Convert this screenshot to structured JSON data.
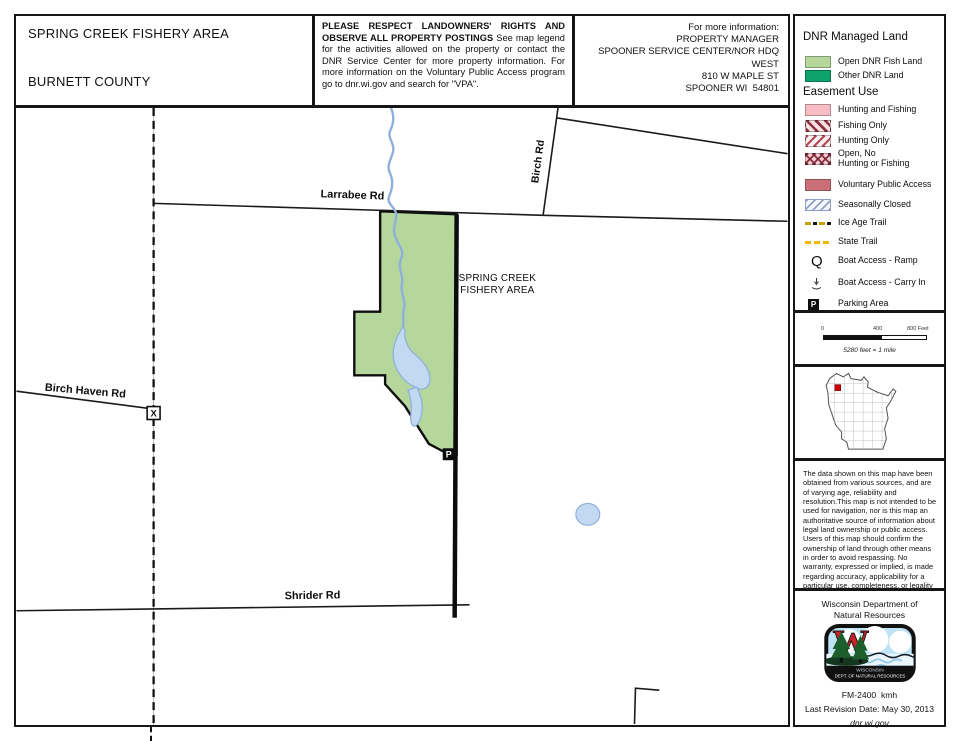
{
  "header": {
    "title": "SPRING CREEK FISHERY AREA",
    "county": "BURNETT COUNTY",
    "notice": {
      "heading": "PLEASE RESPECT LANDOWNERS' RIGHTS AND OBSERVE ALL PROPERTY POSTINGS",
      "body": "See map legend for the activities allowed on the property or contact the DNR Service Center for more property information. For more information on the Voluntary Public Access program go to dnr.wi.gov and search for \"VPA\"."
    },
    "contact": {
      "lines": [
        "For more information:",
        "PROPERTY MANAGER",
        "SPOONER SERVICE CENTER/NOR HDQ",
        "WEST",
        "810 W MAPLE ST",
        "SPOONER WI  54801"
      ]
    }
  },
  "legend": {
    "managed_heading": "DNR Managed Land",
    "managed": [
      {
        "label": "Open DNR Fish Land"
      },
      {
        "label": "Other DNR Land"
      }
    ],
    "easement_heading": "Easement Use",
    "easement": [
      {
        "label": "Hunting and Fishing"
      },
      {
        "label": "Fishing Only"
      },
      {
        "label": "Hunting Only"
      },
      {
        "line1": "Open, No",
        "line2": "Hunting or Fishing"
      },
      {
        "label": "Voluntary Public Access"
      },
      {
        "label": "Seasonally Closed"
      },
      {
        "label": "Ice Age Trail"
      },
      {
        "label": "State Trail"
      },
      {
        "label": "Boat Access - Ramp"
      },
      {
        "label": "Boat Access - Carry In"
      },
      {
        "label": "Parking Area"
      }
    ],
    "icons": {
      "boat_ramp_glyph": "Q",
      "parking_glyph": "P"
    }
  },
  "scale": {
    "tick0": "0",
    "tick1": "400",
    "tick2": "800 Feet",
    "note": "5280 feet = 1 mile"
  },
  "disclaimer": "The data shown on this map have been obtained from various sources, and are of varying age, reliability and resolution.This map is not intended to be used for navigation, nor is this map an authoritative source of information about legal land ownership or public access. Users of this map should confirm the ownership of land through other means in order to avoid respassing. No warranty, expressed or implied, is made regarding accuracy, applicability for a particular use, completeness, or legality of the information depicted on this map.",
  "credits": {
    "agency_line1": "Wisconsin Department of",
    "agency_line2": "Natural Resources",
    "logo_line1": "WISCONSIN",
    "logo_line2": "DEPT. OF NATURAL RESOURCES",
    "form_code": "FM-2400  kmh",
    "revision": "Last Revision Date: May 30, 2013",
    "website": "dnr.wi.gov"
  },
  "map": {
    "labels": {
      "larrabee": "Larrabee Rd",
      "birch": "Birch Rd",
      "birch_haven": "Birch Haven Rd",
      "shrider": "Shrider Rd",
      "area_line1": "SPRING CREEK",
      "area_line2": "FISHERY AREA",
      "parking_marker": "P",
      "gate_marker": "X"
    }
  },
  "colors": {
    "open_fish_land": "#b5d79c",
    "other_dnr_land": "#0da26b",
    "hunting_fishing_pink": "#f7bcc4",
    "voluntary_public_access": "#cb6f77",
    "easement_hatch_red": "#8e3241",
    "seasonally_closed_blue": "#8fa0c4",
    "ice_age_trail_gold": "#c7a102",
    "state_trail_yellow": "#f2b705",
    "water_blue": "#c3d9f1",
    "inset_marker_red": "#cc0000"
  }
}
